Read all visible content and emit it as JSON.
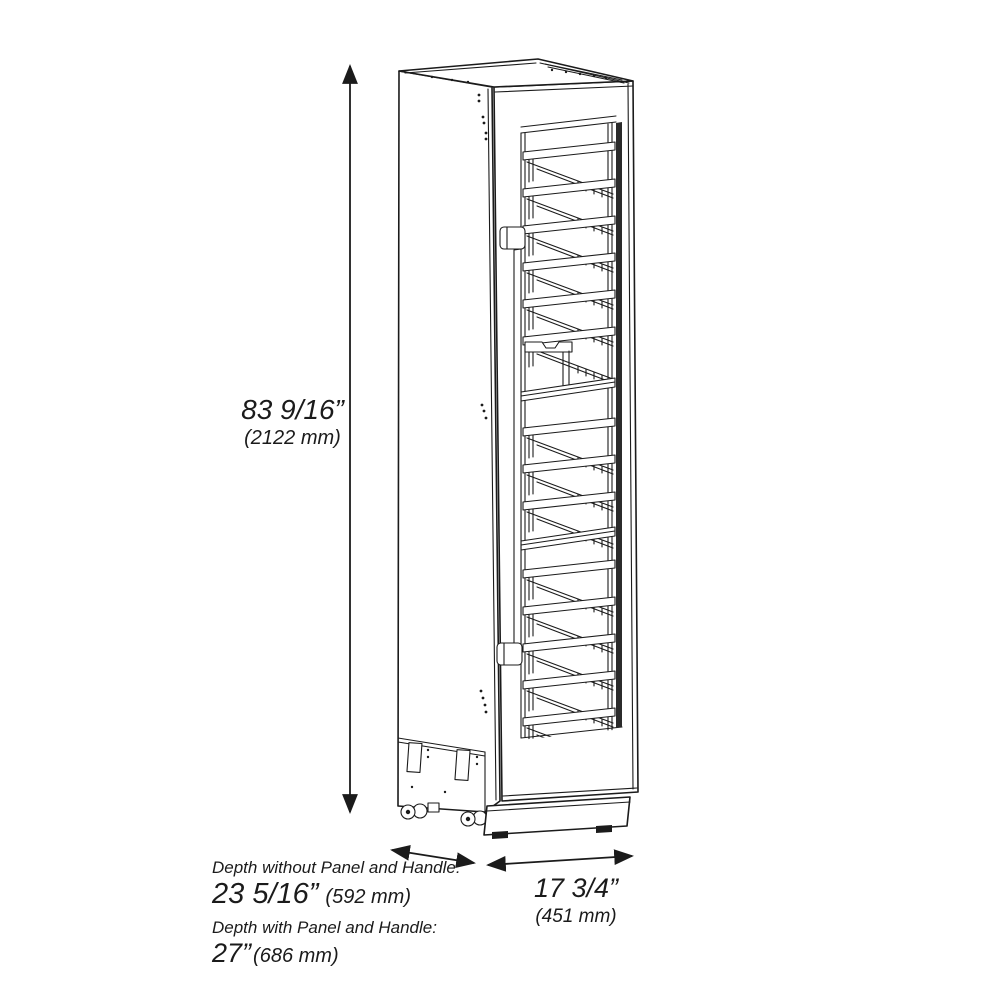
{
  "page": {
    "background_color": "#ffffff",
    "line_color": "#1b1b1b",
    "description": "Isometric line drawing of a tall narrow panel-ready wine cooler column with glass door, wine racks, handle and casters, annotated with overall dimensions"
  },
  "dimensions": {
    "height": {
      "inches": "83 9/16”",
      "mm": "(2122 mm)"
    },
    "depth_without_panel": {
      "label": "Depth without Panel and Handle:",
      "inches": "23 5/16”",
      "mm": "(592 mm)"
    },
    "depth_with_panel": {
      "label": "Depth with Panel and Handle:",
      "inches": "27”",
      "mm": "(686 mm)"
    },
    "width": {
      "inches": "17 3/4”",
      "mm": "(451 mm)"
    }
  }
}
